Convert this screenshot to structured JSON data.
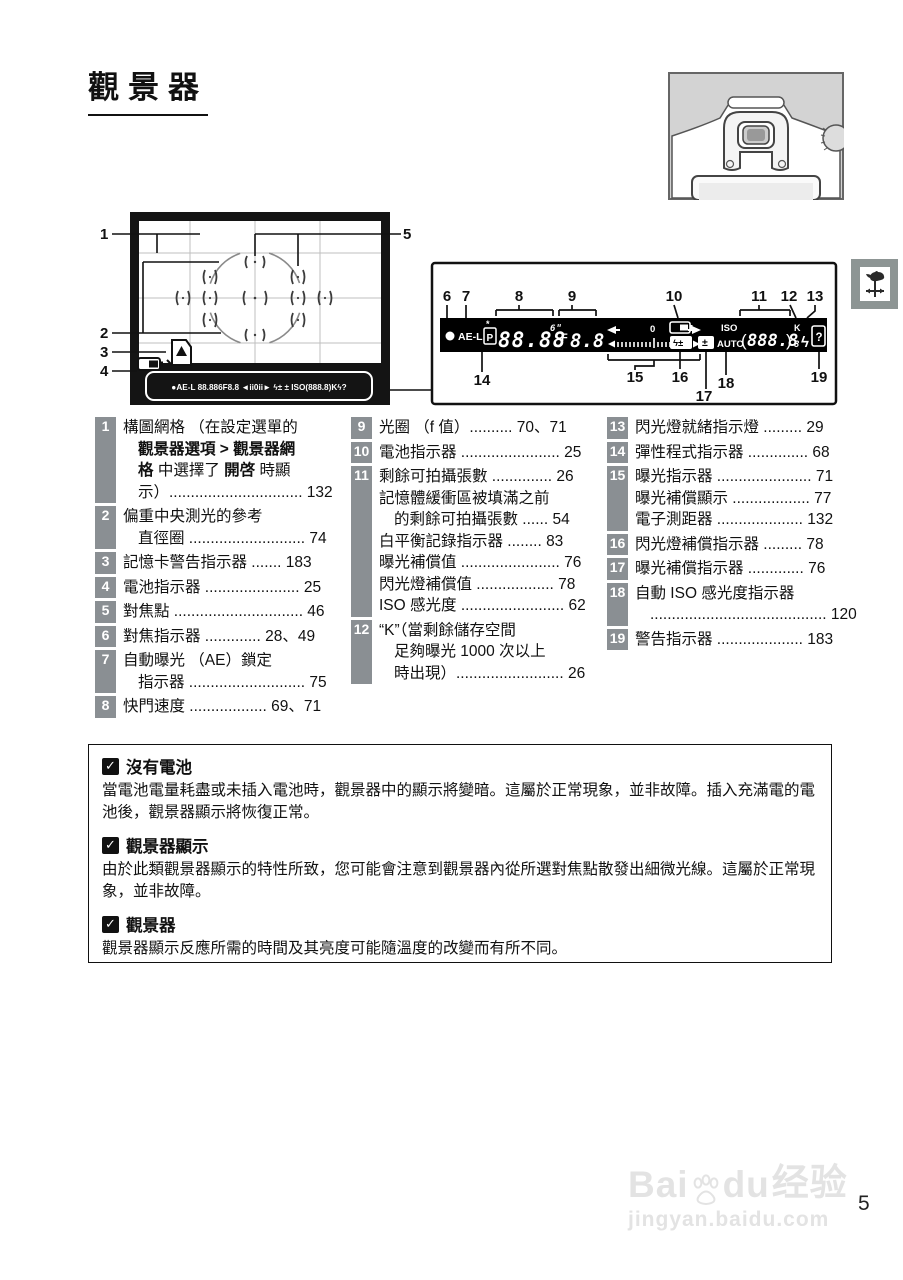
{
  "page": {
    "title": "觀景器",
    "page_number": "5"
  },
  "watermark": {
    "brand_left": "Bai",
    "brand_right": "du",
    "brand_cn": "经验",
    "url": "jingyan.baidu.com"
  },
  "diagram": {
    "vf_callouts": [
      "1",
      "2",
      "3",
      "4",
      "5"
    ],
    "lcd_callouts_top": [
      "6",
      "7",
      "8",
      "9",
      "10",
      "11",
      "12",
      "13"
    ],
    "lcd_callouts_bottom": [
      "14",
      "15",
      "16",
      "17",
      "18",
      "19"
    ],
    "lcd": {
      "ae_lock": "AE-L",
      "mode": "P",
      "flex_star": "*",
      "shutter": "88.88",
      "shutter_small": "6ʺ",
      "f_label": "F",
      "aperture": "8.8",
      "scale_zero": "0",
      "flash_comp": "ϟ±",
      "exp_comp": "±",
      "iso": "ISO",
      "auto": "AUTO",
      "paren_open": "(",
      "iso_digits": "888.8",
      "paren_close": ")",
      "k_small": "8",
      "k": "K",
      "flash_ready": "ϟ",
      "help": "?"
    },
    "mini_lcd": "●AE-L 88.886F8.8 ◄ii0ii► ϟ± ± ISO(888.8)Kϟ?"
  },
  "legend": {
    "columns": [
      {
        "items": [
          {
            "num": "1",
            "lines": [
              {
                "ind": false,
                "seg": [
                  {
                    "t": "構圖網格 （在設定選單的",
                    "b": false
                  }
                ]
              },
              {
                "ind": true,
                "seg": [
                  {
                    "t": "觀景器選項 > 觀景器網",
                    "b": true
                  }
                ]
              },
              {
                "ind": true,
                "seg": [
                  {
                    "t": "格",
                    "b": true
                  },
                  {
                    "t": " 中選擇了 ",
                    "b": false
                  },
                  {
                    "t": "開啓",
                    "b": true
                  },
                  {
                    "t": " 時顯",
                    "b": false
                  }
                ]
              },
              {
                "ind": true,
                "seg": [
                  {
                    "t": "示）............................... 132",
                    "b": false
                  }
                ]
              }
            ]
          },
          {
            "num": "2",
            "lines": [
              {
                "ind": false,
                "seg": [
                  {
                    "t": "偏重中央測光的參考",
                    "b": false
                  }
                ]
              },
              {
                "ind": true,
                "seg": [
                  {
                    "t": "直徑圈 ........................... 74",
                    "b": false
                  }
                ]
              }
            ]
          },
          {
            "num": "3",
            "lines": [
              {
                "ind": false,
                "seg": [
                  {
                    "t": "記憶卡警告指示器 ....... 183",
                    "b": false
                  }
                ]
              }
            ]
          },
          {
            "num": "4",
            "lines": [
              {
                "ind": false,
                "seg": [
                  {
                    "t": "電池指示器 ...................... 25",
                    "b": false
                  }
                ]
              }
            ]
          },
          {
            "num": "5",
            "lines": [
              {
                "ind": false,
                "seg": [
                  {
                    "t": "對焦點 .............................. 46",
                    "b": false
                  }
                ]
              }
            ]
          },
          {
            "num": "6",
            "lines": [
              {
                "ind": false,
                "seg": [
                  {
                    "t": "對焦指示器 ............. 28、49",
                    "b": false
                  }
                ]
              }
            ]
          },
          {
            "num": "7",
            "lines": [
              {
                "ind": false,
                "seg": [
                  {
                    "t": "自動曝光 （AE）鎖定",
                    "b": false
                  }
                ]
              },
              {
                "ind": true,
                "seg": [
                  {
                    "t": "指示器 ........................... 75",
                    "b": false
                  }
                ]
              }
            ]
          },
          {
            "num": "8",
            "lines": [
              {
                "ind": false,
                "seg": [
                  {
                    "t": "快門速度 .................. 69、71",
                    "b": false
                  }
                ]
              }
            ]
          }
        ]
      },
      {
        "items": [
          {
            "num": "9",
            "lines": [
              {
                "ind": false,
                "seg": [
                  {
                    "t": "光圈 （f 值）.......... 70、71",
                    "b": false
                  }
                ]
              }
            ]
          },
          {
            "num": "10",
            "lines": [
              {
                "ind": false,
                "seg": [
                  {
                    "t": "電池指示器 ....................... 25",
                    "b": false
                  }
                ]
              }
            ]
          },
          {
            "num": "11",
            "lines": [
              {
                "ind": false,
                "seg": [
                  {
                    "t": "剩餘可拍攝張數 .............. 26",
                    "b": false
                  }
                ]
              },
              {
                "ind": false,
                "seg": [
                  {
                    "t": "記憶體緩衝區被填滿之前",
                    "b": false
                  }
                ]
              },
              {
                "ind": true,
                "seg": [
                  {
                    "t": "的剩餘可拍攝張數 ...... 54",
                    "b": false
                  }
                ]
              },
              {
                "ind": false,
                "seg": [
                  {
                    "t": "白平衡記錄指示器 ........ 83",
                    "b": false
                  }
                ]
              },
              {
                "ind": false,
                "seg": [
                  {
                    "t": "曝光補償值 ....................... 76",
                    "b": false
                  }
                ]
              },
              {
                "ind": false,
                "seg": [
                  {
                    "t": "閃光燈補償值 .................. 78",
                    "b": false
                  }
                ]
              },
              {
                "ind": false,
                "seg": [
                  {
                    "t": "ISO 感光度 ........................ 62",
                    "b": false
                  }
                ]
              }
            ]
          },
          {
            "num": "12",
            "lines": [
              {
                "ind": false,
                "seg": [
                  {
                    "t": "“K”（當剩餘儲存空間",
                    "b": false
                  }
                ]
              },
              {
                "ind": true,
                "seg": [
                  {
                    "t": "足夠曝光 1000 次以上",
                    "b": false
                  }
                ]
              },
              {
                "ind": true,
                "seg": [
                  {
                    "t": "時出現）......................... 26",
                    "b": false
                  }
                ]
              }
            ]
          }
        ]
      },
      {
        "items": [
          {
            "num": "13",
            "lines": [
              {
                "ind": false,
                "seg": [
                  {
                    "t": "閃光燈就緒指示燈 ......... 29",
                    "b": false
                  }
                ]
              }
            ]
          },
          {
            "num": "14",
            "lines": [
              {
                "ind": false,
                "seg": [
                  {
                    "t": "彈性程式指示器 .............. 68",
                    "b": false
                  }
                ]
              }
            ]
          },
          {
            "num": "15",
            "lines": [
              {
                "ind": false,
                "seg": [
                  {
                    "t": "曝光指示器 ...................... 71",
                    "b": false
                  }
                ]
              },
              {
                "ind": false,
                "seg": [
                  {
                    "t": "曝光補償顯示 .................. 77",
                    "b": false
                  }
                ]
              },
              {
                "ind": false,
                "seg": [
                  {
                    "t": "電子測距器 .................... 132",
                    "b": false
                  }
                ]
              }
            ]
          },
          {
            "num": "16",
            "lines": [
              {
                "ind": false,
                "seg": [
                  {
                    "t": "閃光燈補償指示器 ......... 78",
                    "b": false
                  }
                ]
              }
            ]
          },
          {
            "num": "17",
            "lines": [
              {
                "ind": false,
                "seg": [
                  {
                    "t": "曝光補償指示器 ............. 76",
                    "b": false
                  }
                ]
              }
            ]
          },
          {
            "num": "18",
            "lines": [
              {
                "ind": false,
                "seg": [
                  {
                    "t": "自動 ISO 感光度指示器",
                    "b": false
                  }
                ]
              },
              {
                "ind": true,
                "seg": [
                  {
                    "t": "......................................... 120",
                    "b": false
                  }
                ]
              }
            ]
          },
          {
            "num": "19",
            "lines": [
              {
                "ind": false,
                "seg": [
                  {
                    "t": "警告指示器 .................... 183",
                    "b": false
                  }
                ]
              }
            ]
          }
        ]
      }
    ]
  },
  "notes": {
    "check_glyph": "✓",
    "items": [
      {
        "title": "沒有電池",
        "body": "當電池電量耗盡或未插入電池時，觀景器中的顯示將變暗。這屬於正常現象，並非故障。插入充滿電的電池後，觀景器顯示將恢復正常。"
      },
      {
        "title": "觀景器顯示",
        "body": "由於此類觀景器顯示的特性所致，您可能會注意到觀景器內從所選對焦點散發出細微光線。這屬於正常現象，並非故障。"
      },
      {
        "title": "觀景器",
        "body": "觀景器顯示反應所需的時間及其亮度可能隨溫度的改變而有所不同。"
      }
    ]
  }
}
